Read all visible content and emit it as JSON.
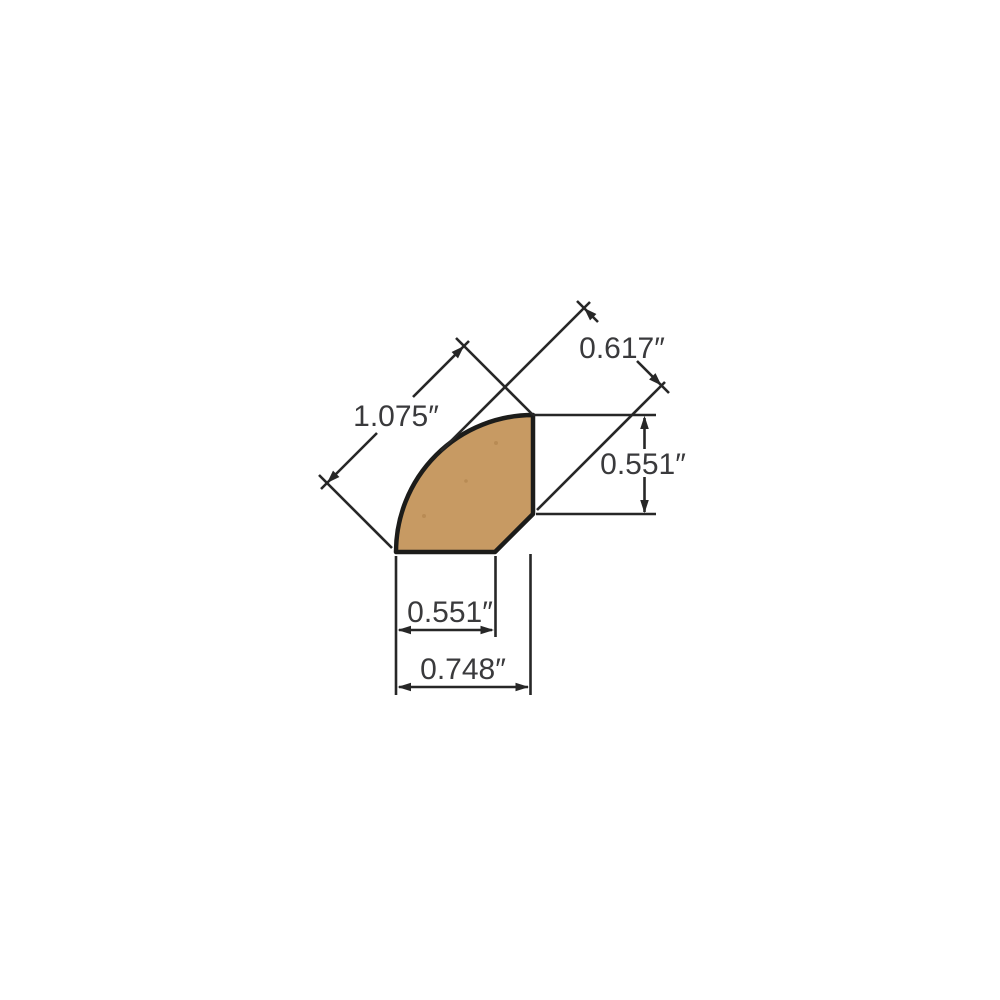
{
  "diagram": {
    "title": "quarter-round-molding-profile-dimension-drawing",
    "dimensions": {
      "curve_face_width": "1.075″",
      "diagonal_overall_depth": "0.617″",
      "right_side_height": "0.551″",
      "bottom_flat_width": "0.551″",
      "bottom_overall_width": "0.748″"
    },
    "colors": {
      "wood_fill": "#C79A63",
      "wood_speckle": "#A87A42",
      "outline": "#1C1C1A",
      "dimension_lines": "#272727",
      "text": "#3A3A3C",
      "background": "#FFFFFF"
    }
  }
}
